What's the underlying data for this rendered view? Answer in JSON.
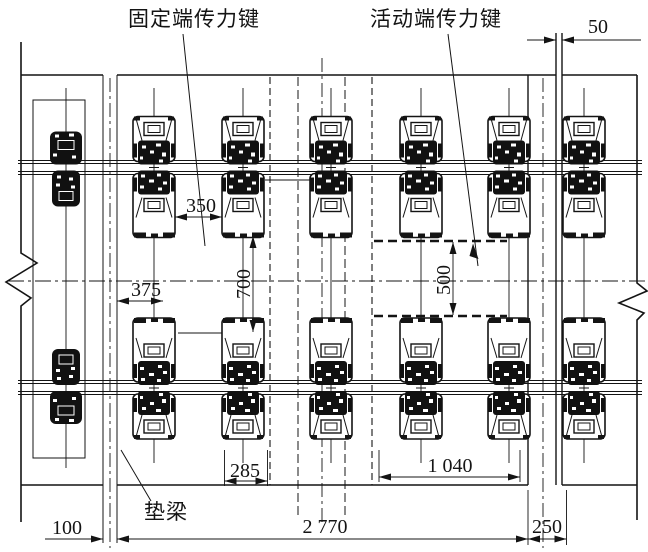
{
  "drawing": {
    "labels": {
      "fixed_key": "固定端传力键",
      "movable_key": "活动端传力键",
      "bolster": "垫梁"
    },
    "dimensions": {
      "joint_gap": "50",
      "fixed_key_clear": "350",
      "edge_offset": "375",
      "fixed_key_length": "700",
      "movable_key_length": "500",
      "key_width": "285",
      "movable_key_span": "1 040",
      "seam": "100",
      "bolster_span": "2 770",
      "end_block": "250"
    },
    "colors": {
      "ink": "#141414",
      "paper": "#ffffff"
    }
  }
}
